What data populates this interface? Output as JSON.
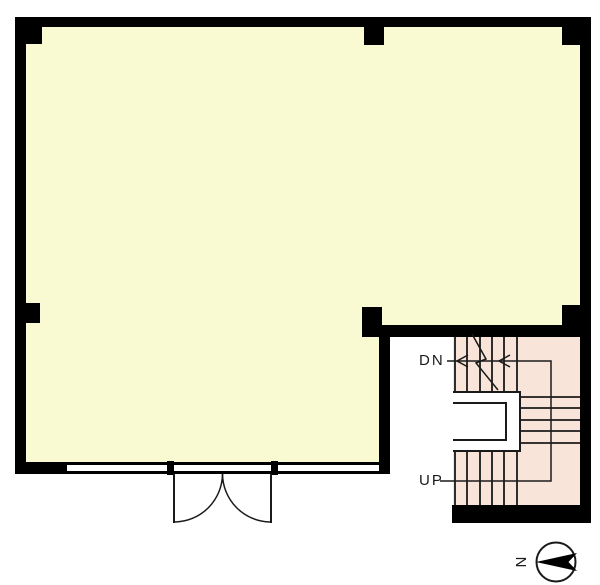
{
  "floorplan": {
    "labels": {
      "down": "DN",
      "up": "UP",
      "north": "N"
    },
    "colors": {
      "wall": "#000000",
      "room_fill": "#fafad2",
      "stair_fill": "#f8e4d8",
      "line": "#1a1a1a",
      "background": "#ffffff",
      "label_text": "#1a1a1a"
    }
  }
}
